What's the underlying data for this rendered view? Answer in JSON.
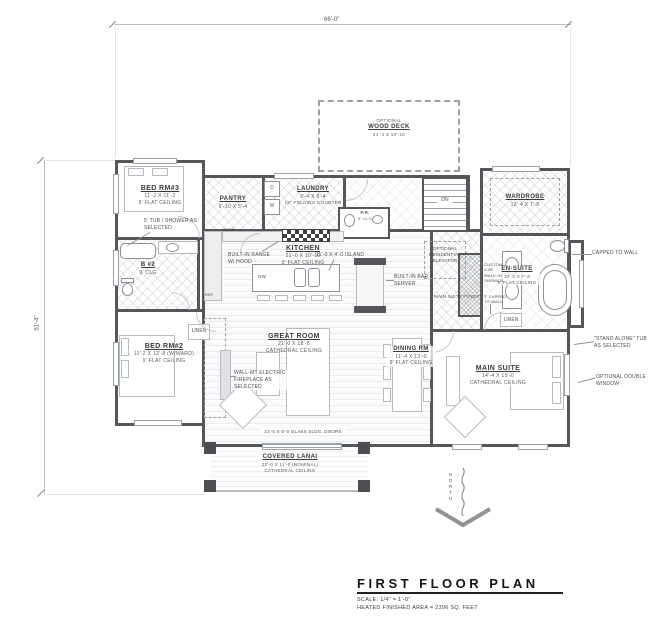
{
  "title_block": {
    "title": "FIRST FLOOR PLAN",
    "scale": "SCALE: 1/4\" = 1'-0\"",
    "area": "HEATED FINISHED AREA = 2396 SQ. FEET"
  },
  "dimensions": {
    "top": "66'-0\"",
    "left": "51'-4\""
  },
  "north": {
    "label": "NORTH"
  },
  "rooms": {
    "bed3": {
      "name": "BED RM#3",
      "dim": "11'-2 X 11'-2",
      "ceiling": "9' FLAT CEILING"
    },
    "bath2": {
      "name": "B #2",
      "ceiling": "9' CLG"
    },
    "bed2": {
      "name": "BED RM#2",
      "dim": "11'-2 X 12'-8 (W/WARD)",
      "ceiling": "9' FLAT CEILING"
    },
    "pantry": {
      "name": "PANTRY",
      "dim": "6'-10 X 5'-4"
    },
    "laundry": {
      "name": "LAUNDRY",
      "dim": "9'-4 X 8'-4",
      "note": "18\" FOLDING COUNTER"
    },
    "powder": {
      "name": "P.R.",
      "ceiling": "9' CLG"
    },
    "kitchen": {
      "name": "KITCHEN",
      "dim": "21'-0 X 10'-10",
      "ceiling": "9' FLAT CEILING"
    },
    "great_room": {
      "name": "GREAT ROOM",
      "dim": "21'-0 X 18'-8",
      "ceiling": "CATHEDRAL CEILING"
    },
    "dining": {
      "name": "DINING RM",
      "dim": "11'-4 X 13'-0",
      "ceiling": "9' FLAT CEILING"
    },
    "main_suite": {
      "name": "MAIN SUITE",
      "dim": "14'-4 X 15'-0",
      "ceiling": "CATHEDRAL CEILING"
    },
    "wardrobe": {
      "name": "WARDROBE",
      "dim": "12'-4 X 7'-8"
    },
    "ensuite": {
      "name": "EN-SUITE",
      "dim": "10'-0 X 7'-8",
      "ceiling": "9' FLAT CEILING"
    },
    "lanai": {
      "name": "COVERED LANAI",
      "dim": "22'-0 X 11'-0 (NOMINAL)",
      "ceiling": "CATHEDRAL CEILING"
    },
    "deck": {
      "prefix": "OPTIONAL",
      "name": "WOOD DECK",
      "dim": "21'-4 X 10'-10"
    }
  },
  "annotations": {
    "tub_shower": "5' TUB / SHOWER AS SELECTED",
    "built_in_range": "BUILT-IN RANGE W/ HOOD",
    "island": "11'-0 X 4'-0 ISLAND",
    "bar_server": "BUILT-IN BAR / SERVER",
    "elevator": "OPTIONAL RESIDENTIAL ELEVATOR",
    "ms_foyer": "MAIN SUITE FOYER",
    "walkin_shower": "CUSTOM 4'X6' WALK-IN SHOWER",
    "capped_shower": "7' CAPPED TO WALL",
    "capped_wall": "CAPPED TO WALL",
    "standalone_tub": "\"STAND ALONE\" TUB AS SELECTED",
    "double_window": "OPTIONAL DOUBLE WINDOW",
    "fireplace": "WALL-MT ELECTRIC FIREPLACE AS SELECTED",
    "sliding_doors": "21'-0 X 8'-0 GLASS SLDG. DOORS"
  },
  "fixtures": {
    "oven": "OVEN",
    "ref": "REF.",
    "dw": "DW",
    "dryer": "D",
    "washer": "W",
    "down": "DN",
    "linen": "LINEN"
  }
}
